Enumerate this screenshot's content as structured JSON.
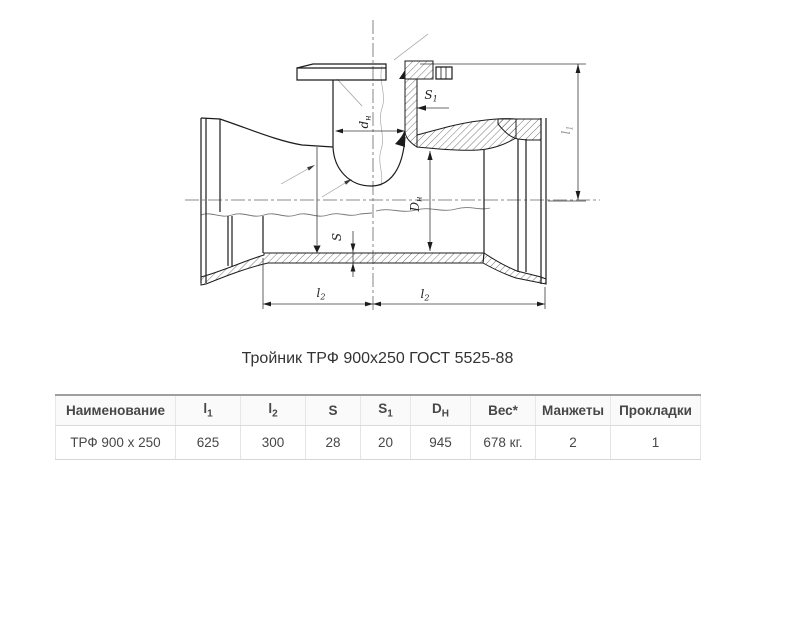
{
  "title": "Тройник ТРФ 900х250 ГОСТ 5525-88",
  "drawing": {
    "description": "sectional-drawing-of-pipe-tee-with-flanged-branch",
    "labels": {
      "d_n": {
        "base": "d",
        "sub": "н"
      },
      "s1": {
        "base": "S",
        "sub": "1"
      },
      "D_n": {
        "base": "D",
        "sub": "н"
      },
      "s": {
        "base": "S"
      },
      "l2_left": {
        "base": "l",
        "sub": "2"
      },
      "l2_right": {
        "base": "l",
        "sub": "2"
      },
      "l1_vert": {
        "base": "l",
        "sub": "1"
      }
    },
    "colors": {
      "outline": "#1c1c1c",
      "dimension": "#3a3a3a",
      "faint": "#999999"
    }
  },
  "table": {
    "columns": [
      {
        "base": "Наименование"
      },
      {
        "base": "l",
        "sub": "1"
      },
      {
        "base": "l",
        "sub": "2"
      },
      {
        "base": "S"
      },
      {
        "base": "S",
        "sub": "1"
      },
      {
        "base": "D",
        "sub": "Н"
      },
      {
        "base": "Вес*"
      },
      {
        "base": "Манжеты"
      },
      {
        "base": "Прокладки"
      }
    ],
    "row": [
      "ТРФ 900 х 250",
      "625",
      "300",
      "28",
      "20",
      "945",
      "678 кг.",
      "2",
      "1"
    ]
  }
}
